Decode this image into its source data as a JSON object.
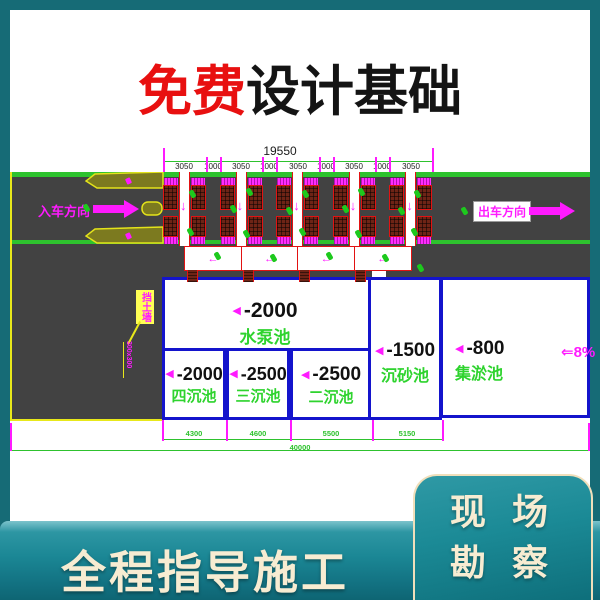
{
  "headline": {
    "highlight": "免费",
    "rest": "设计基础"
  },
  "cad": {
    "dim_total_top": "19550",
    "dim_segments_top": [
      "3050",
      "1000",
      "3050",
      "1000",
      "3050",
      "1000",
      "3050",
      "1000",
      "3050"
    ],
    "entry_label": "入车方向",
    "exit_label": "出车方向",
    "slope_label": "⇐8%",
    "callout_box_label": "挡土墙",
    "callout_note": "300x300",
    "pools": {
      "pump": {
        "depth": "-2000",
        "name": "水泵池"
      },
      "fourth": {
        "depth": "-2000",
        "name": "四沉池"
      },
      "third": {
        "depth": "-2500",
        "name": "三沉池"
      },
      "second": {
        "depth": "-2500",
        "name": "二沉池"
      },
      "grit": {
        "depth": "-1500",
        "name": "沉砂池"
      },
      "silt": {
        "depth": "-800",
        "name": "集淤池"
      }
    },
    "dim_segments_bottom": [
      "4300",
      "4600",
      "5500",
      "5150"
    ],
    "dim_total_bottom": "40000"
  },
  "icons": {
    "depth_marker": "◀",
    "down_arrow": "↓",
    "flow_arrow": "←"
  },
  "bottom_banner": {
    "label": "全程指导施工"
  },
  "corner_badge": {
    "line1": "现 场",
    "line2": "勘 察"
  },
  "colors": {
    "accent_red": "#e81010",
    "magenta": "#ff1aff",
    "cad_green": "#2ec22e",
    "cad_blue": "#1414cc",
    "frame_teal": "#166b76",
    "cream": "#f7ecd2"
  }
}
